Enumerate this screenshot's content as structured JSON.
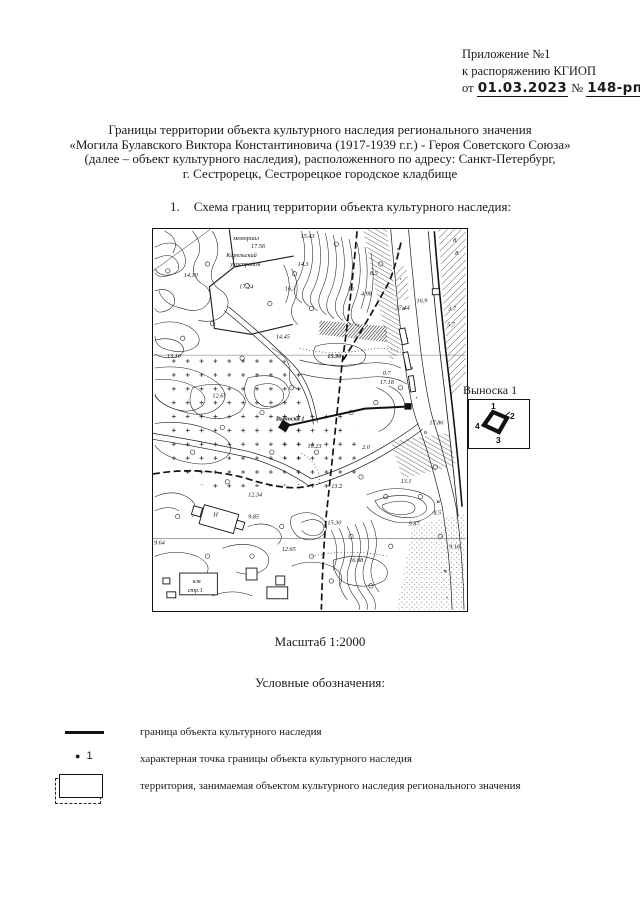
{
  "header": {
    "line1": "Приложение №1",
    "line2": "к распоряжению КГИОП",
    "prefix": "от",
    "date": "01.03.2023",
    "num_sign": "№",
    "number": "148-рп"
  },
  "title": {
    "line1": "Границы территории объекта культурного наследия регионального значения",
    "line2": "«Могила Булавского Виктора Константиновича (1917-1939 г.г.) - Героя Советского Союза»",
    "line3": "(далее – объект культурного наследия), расположенного по адресу: Санкт-Петербург,",
    "line4": "г. Сестрорецк, Сестрорецкое городское кладбище"
  },
  "section1": {
    "number": "1.",
    "text": "Схема границ территории объекта культурного наследия:"
  },
  "scale_label": "Масштаб 1:2000",
  "legend_title": "Условные обозначения:",
  "legend": {
    "items": [
      {
        "label": "граница объекта культурного наследия"
      },
      {
        "point_number": "1",
        "label": "характерная точка границы объекта культурного наследия"
      },
      {
        "label": "территория, занимаемая объектом культурного наследия регионального значения"
      }
    ]
  },
  "callout": {
    "title": "Выноска 1",
    "points": {
      "p1": "1",
      "p2": "2",
      "p3": "3",
      "p4": "4"
    }
  },
  "map": {
    "labels": [
      {
        "t": "мемориал",
        "x": 81,
        "y": 11,
        "c": "it",
        "s": 7.2
      },
      {
        "t": "17.56",
        "x": 99,
        "y": 19,
        "s": 6
      },
      {
        "t": "Карельский",
        "x": 74,
        "y": 28,
        "c": "it",
        "s": 7.2
      },
      {
        "t": "укрепрайон",
        "x": 78,
        "y": 37,
        "c": "it",
        "s": 7.2
      },
      {
        "t": "15.43",
        "x": 149,
        "y": 9
      },
      {
        "t": "14.10",
        "x": 31,
        "y": 48
      },
      {
        "t": "17.24",
        "x": 87,
        "y": 60
      },
      {
        "t": "14.3",
        "x": 146,
        "y": 37
      },
      {
        "t": "16.3",
        "x": 133,
        "y": 62
      },
      {
        "t": "14.45",
        "x": 124,
        "y": 110
      },
      {
        "t": "8.5",
        "x": 219,
        "y": 46
      },
      {
        "t": "4.98",
        "x": 210,
        "y": 67
      },
      {
        "t": "17.44",
        "x": 245,
        "y": 81
      },
      {
        "t": "16.9",
        "x": 266,
        "y": 74
      },
      {
        "t": "3.7",
        "x": 298,
        "y": 82
      },
      {
        "t": "5.7",
        "x": 297,
        "y": 98
      },
      {
        "t": "8.",
        "x": 303,
        "y": 13
      },
      {
        "t": "8.",
        "x": 305,
        "y": 26
      },
      {
        "t": "13.10",
        "x": 14,
        "y": 130
      },
      {
        "t": "15.90",
        "x": 176,
        "y": 130,
        "c": "b",
        "s": 7
      },
      {
        "t": "12.61",
        "x": 60,
        "y": 170
      },
      {
        "t": "0.7",
        "x": 232,
        "y": 147
      },
      {
        "t": "17.18",
        "x": 229,
        "y": 156
      },
      {
        "t": "Выноска 1",
        "x": 124,
        "y": 193,
        "c": "b",
        "s": 7
      },
      {
        "t": "10.23",
        "x": 156,
        "y": 221
      },
      {
        "t": "17.86",
        "x": 279,
        "y": 197
      },
      {
        "t": "2.0",
        "x": 211,
        "y": 222
      },
      {
        "t": "13.2",
        "x": 180,
        "y": 261
      },
      {
        "t": "12.34",
        "x": 96,
        "y": 270
      },
      {
        "t": "15.30",
        "x": 176,
        "y": 298
      },
      {
        "t": "9.85",
        "x": 96,
        "y": 292
      },
      {
        "t": "9.87",
        "x": 258,
        "y": 299
      },
      {
        "t": "8.5",
        "x": 283,
        "y": 288
      },
      {
        "t": "13.1",
        "x": 250,
        "y": 256
      },
      {
        "t": "9.64",
        "x": 1,
        "y": 318
      },
      {
        "t": "12.65",
        "x": 130,
        "y": 325
      },
      {
        "t": "16.08",
        "x": 198,
        "y": 336
      },
      {
        "t": "9.16",
        "x": 299,
        "y": 322
      },
      {
        "t": "кж",
        "x": 40,
        "y": 357,
        "s": 5.8
      },
      {
        "t": "стр.1",
        "x": 35,
        "y": 366,
        "s": 5.8
      },
      {
        "t": "Н",
        "x": 61,
        "y": 290,
        "s": 6
      }
    ]
  }
}
